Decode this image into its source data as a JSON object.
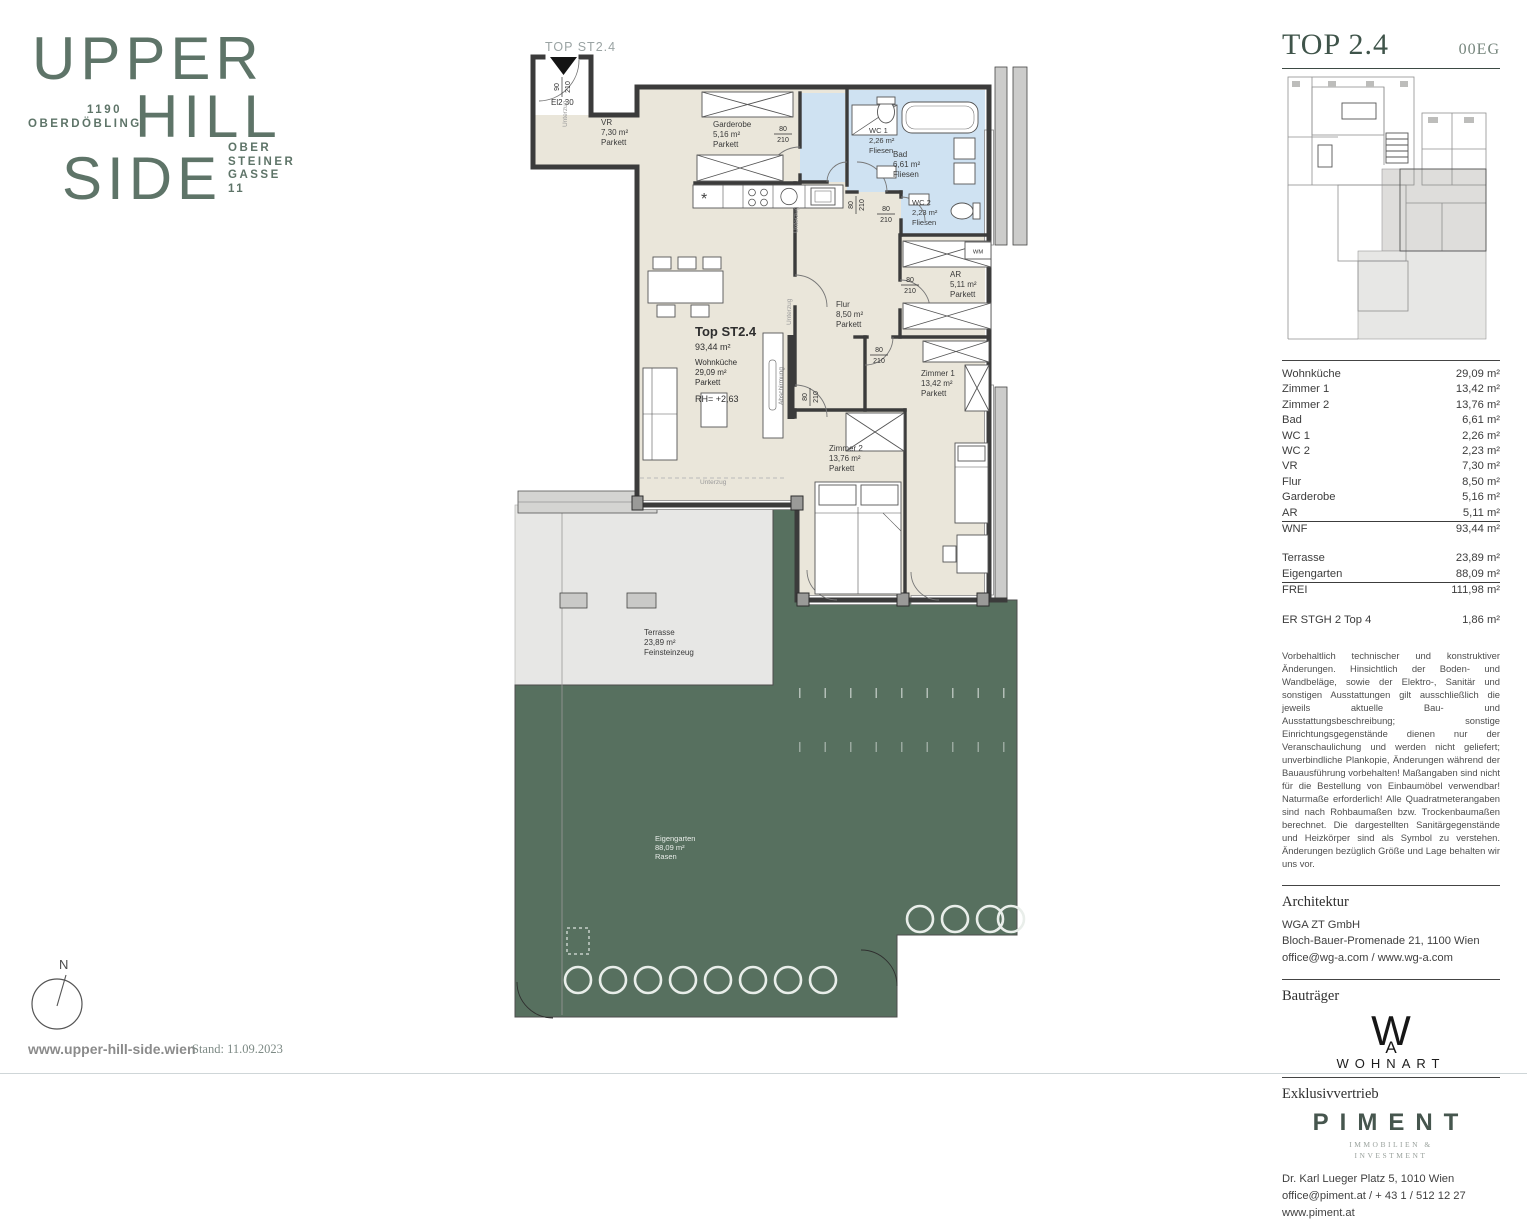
{
  "brand": {
    "line1": "UPPER",
    "line2": "HILL",
    "line3": "SIDE",
    "district": [
      "1190",
      "OBERDÖBLING"
    ],
    "address": [
      "OBER",
      "STEINER",
      "GASSE",
      "11"
    ]
  },
  "plan": {
    "top_label": "TOP ST2.4",
    "entrance": {
      "w": "90",
      "h": "210",
      "door": "El2 30"
    },
    "door": {
      "w": "80",
      "h": "210"
    },
    "annot": {
      "unterzug": "Unterzug",
      "abschirmung": "Abschirmung",
      "wm": "WM"
    },
    "unit": {
      "title": "Top ST2.4",
      "total": "93,44 m²",
      "name": "Wohnküche",
      "area": "29,09 m²",
      "floor": "Parkett",
      "rh": "RH= +2,63"
    },
    "rooms": {
      "vr": {
        "name": "VR",
        "area": "7,30 m²",
        "floor": "Parkett"
      },
      "garderobe": {
        "name": "Garderobe",
        "area": "5,16 m²",
        "floor": "Parkett"
      },
      "wc1": {
        "name": "WC 1",
        "area": "2,26 m²",
        "floor": "Fliesen"
      },
      "bad": {
        "name": "Bad",
        "area": "6,61 m²",
        "floor": "Fliesen"
      },
      "wc2": {
        "name": "WC 2",
        "area": "2,23 m²",
        "floor": "Fliesen"
      },
      "ar": {
        "name": "AR",
        "area": "5,11 m²",
        "floor": "Parkett"
      },
      "flur": {
        "name": "Flur",
        "area": "8,50 m²",
        "floor": "Parkett"
      },
      "zimmer1": {
        "name": "Zimmer 1",
        "area": "13,42 m²",
        "floor": "Parkett"
      },
      "zimmer2": {
        "name": "Zimmer 2",
        "area": "13,76 m²",
        "floor": "Parkett"
      },
      "terrasse": {
        "name": "Terrasse",
        "area": "23,89 m²",
        "floor": "Feinsteinzeug"
      },
      "garten": {
        "name": "Eigengarten",
        "area": "88,09 m²",
        "floor": "Rasen"
      }
    },
    "colors": {
      "garden": "#57705f",
      "floor": "#eae6da",
      "tiles": "#cfe2f2",
      "wall": "#3b3b3b"
    }
  },
  "sidebar": {
    "title": "TOP 2.4",
    "floor_tag": "00EG",
    "areas": [
      {
        "label": "Wohnküche",
        "value": "29,09 m²"
      },
      {
        "label": "Zimmer 1",
        "value": "13,42 m²"
      },
      {
        "label": "Zimmer 2",
        "value": "13,76 m²"
      },
      {
        "label": "Bad",
        "value": "6,61 m²"
      },
      {
        "label": "WC 1",
        "value": "2,26 m²"
      },
      {
        "label": "WC 2",
        "value": "2,23 m²"
      },
      {
        "label": "VR",
        "value": "7,30 m²"
      },
      {
        "label": "Flur",
        "value": "8,50 m²"
      },
      {
        "label": "Garderobe",
        "value": "5,16 m²"
      },
      {
        "label": "AR",
        "value": "5,11 m²"
      }
    ],
    "wnf": {
      "label": "WNF",
      "value": "93,44 m²"
    },
    "outdoor": [
      {
        "label": "Terrasse",
        "value": "23,89 m²"
      },
      {
        "label": "Eigengarten",
        "value": "88,09 m²"
      }
    ],
    "frei": {
      "label": "FREI",
      "value": "111,98 m²"
    },
    "extra": {
      "label": "ER STGH 2 Top 4",
      "value": "1,86 m²"
    },
    "disclaimer": "Vorbehaltlich technischer und konstruktiver Änderungen. Hinsichtlich der Boden- und Wandbeläge, sowie der Elektro-, Sanitär und sonstigen Ausstattungen gilt ausschließlich die jeweils aktuelle Bau- und Ausstattungsbeschreibung; sonstige Einrichtungsgegenstände dienen nur der Veranschaulichung und werden nicht geliefert; unverbindliche Plankopie, Änderungen während der Bauausführung vorbehalten! Maßangaben sind nicht für die Bestellung von Einbaumöbel verwendbar! Naturmaße erforderlich! Alle Quadratmeterangaben sind nach Rohbaumaßen bzw. Trockenbaumaßen berechnet. Die dargestellten Sanitärgegenstände und Heizkörper sind als Symbol zu verstehen. Änderungen bezüglich Größe und Lage behalten wir uns vor.",
    "architektur": {
      "heading": "Architektur",
      "lines": [
        "WGA ZT GmbH",
        "Bloch-Bauer-Promenade 21, 1100 Wien",
        "office@wg-a.com / www.wg-a.com"
      ]
    },
    "bautraeger": {
      "heading": "Bauträger",
      "monogram_w": "W",
      "monogram_a": "A",
      "name": "WOHNART"
    },
    "vertrieb": {
      "heading": "Exklusivvertrieb",
      "logo": "PIMENT",
      "sub1": "IMMOBILIEN &",
      "sub2": "INVESTMENT",
      "lines": [
        "Dr. Karl Lueger Platz 5, 1010 Wien",
        "office@piment.at / + 43 1 / 512 12 27",
        "www.piment.at"
      ]
    }
  },
  "footer": {
    "compass": "N",
    "website": "www.upper-hill-side.wien",
    "stand": "Stand: 11.09.2023"
  }
}
